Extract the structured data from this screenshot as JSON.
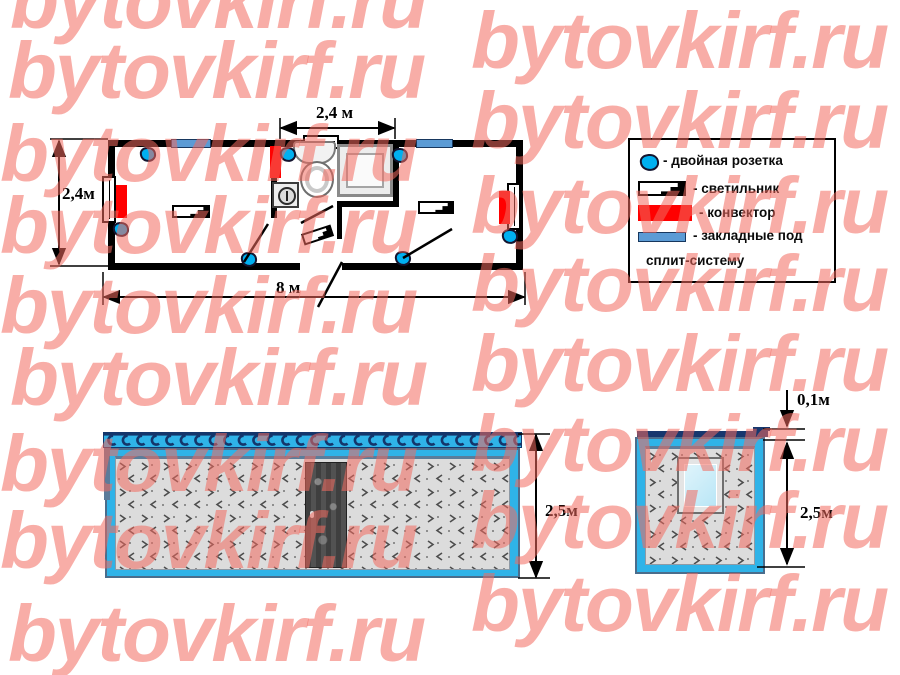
{
  "watermark": {
    "text": "bytovkirf.ru",
    "color": "rgba(242,106,94,0.55)"
  },
  "floor_plan": {
    "dim_top": "2,4 м",
    "dim_left": "2,4м",
    "dim_bottom": "8 м"
  },
  "elevations": {
    "side_height": "2,5м",
    "end_roof_thickness": "0,1м",
    "end_height": "2,5м"
  },
  "legend": {
    "items": [
      {
        "icon": "double-socket-icon",
        "label": "- двойная розетка"
      },
      {
        "icon": "light-fixture-icon",
        "label": "- светильник"
      },
      {
        "icon": "convector-icon",
        "label": "- конвектор"
      },
      {
        "icon": "split-mount-icon",
        "label": "- закладные под"
      },
      {
        "icon": "",
        "label": "сплит-систему"
      }
    ]
  },
  "colors": {
    "body_cyan": "#2FB3E8",
    "roof_navy": "#17376E",
    "convector_red": "#FF0000",
    "socket_cyan": "#00B0F0",
    "mount_blue": "#5B9BD5",
    "panel_gray": "#DCDCDC"
  }
}
